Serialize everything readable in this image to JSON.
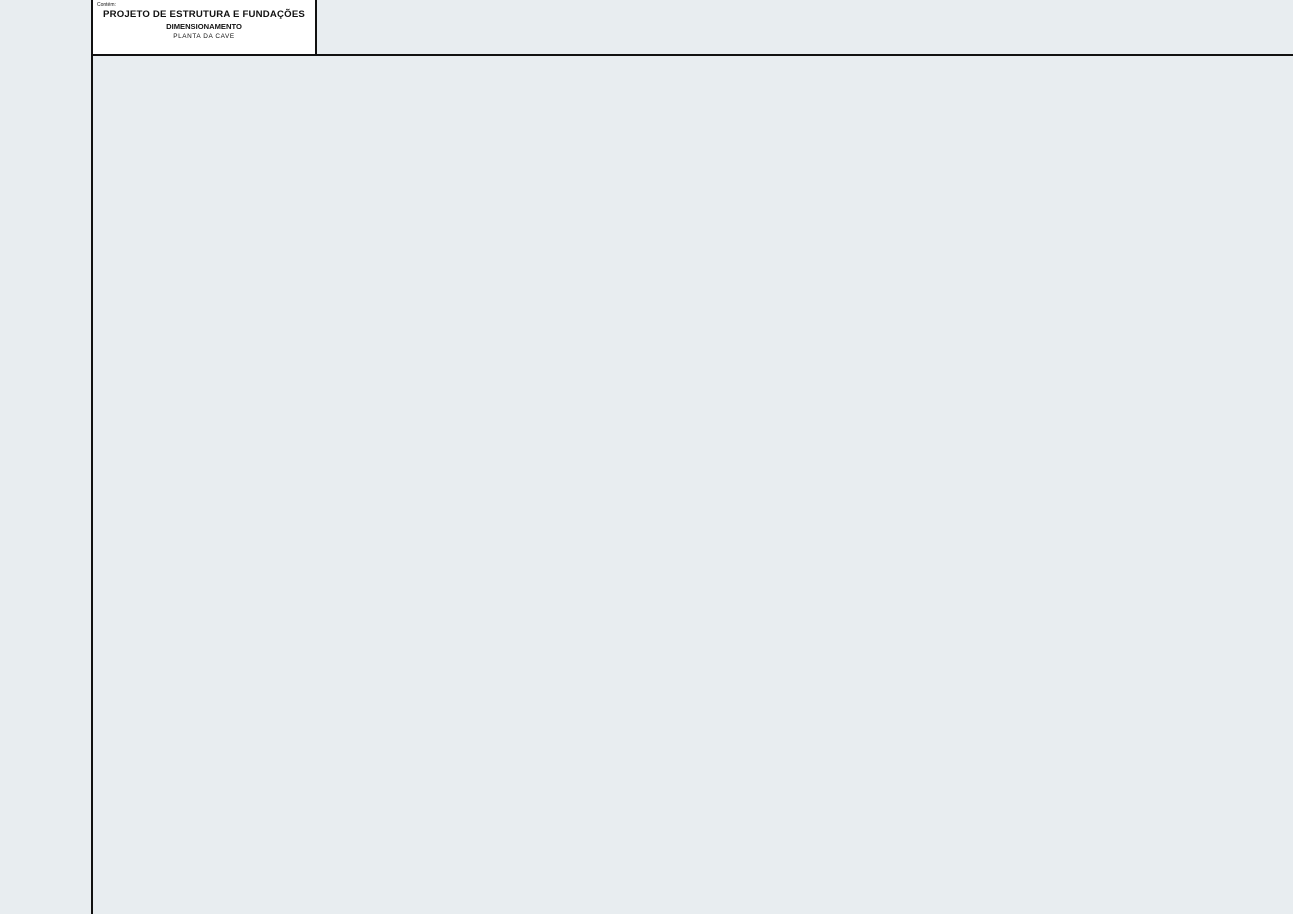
{
  "plan": {
    "annotations": {
      "ramp": "Rampa Incl.15,15%",
      "roller": "Rolo",
      "mlr_upper": "MLR",
      "mlr_lower": "MLR",
      "wall_note_l1": "Contorno",
      "wall_note_l2": "muro sup.",
      "room_p": "P",
      "room_d": "D",
      "level_tags": [
        {
          "l1": "P1.05",
          "l2": "-4.10"
        },
        {
          "l1": "P1.03",
          "l2": "-2.80"
        },
        {
          "l1": "P1.02",
          "l2": "-3.60"
        }
      ]
    }
  },
  "legend": {
    "title": "LEGENDA:",
    "items": [
      {
        "symbol": "pilar",
        "label": "-Pilar"
      },
      {
        "symbol": "pilar-nasce-na-laje",
        "label": "-Pilar nasce na laje"
      },
      {
        "symbol": "abertura-na-laje",
        "label": "-Abertura na Laje"
      }
    ]
  },
  "eurocodes": {
    "title": "EUROCÓDIGOS APLICÁVEIS",
    "items": [
      "NP EN 1990 (2009)",
      "NP EN 1991-1-1 (2009)",
      "NP EN 1991-1-4 (2009)",
      "NP EN 1992-1-1 (2010)",
      "NP EN 1994-1-1 (2011)",
      "NP EN 1997-1-1 (2010)",
      "NP EN 1998-1 (2010)"
    ]
  },
  "concrete": {
    "title": "BETÃO",
    "title_note": "(NP EN 206-1)",
    "rows": [
      {
        "elements": [
          "Fundações",
          "Muros"
        ],
        "spec": "C25/30 XC2 Dmáx. 20 Cl 0.20 S3"
      },
      {
        "elements": [
          "Pilares",
          "Vigas",
          "Lajes"
        ],
        "spec": "C30/37 XC3 Dmáx. 15 Cl 0.20 S3"
      },
      {
        "elements": [
          "Piscina"
        ],
        "spec": "C40/50 XC1 Dmáx. 20 CL 0.20 S3"
      }
    ],
    "steel_title": "AÇO",
    "steel_note": "(NP ENV 13670-1)",
    "steel_row": {
      "element": "Fundações e Estruturas",
      "spec": "A 500 NR SD"
    }
  },
  "covers": {
    "title": "RECOBRIMENTOS",
    "rows": [
      {
        "element": "Fundações",
        "value": "50 mm"
      },
      {
        "element": "Muros",
        "value": "50 mm"
      },
      {
        "element": "Pilares",
        "value": "35 mm"
      },
      {
        "element": "Vigas",
        "value": "35 mm"
      },
      {
        "element": "Lajes",
        "value": "35 mm"
      }
    ]
  },
  "titleblock": {
    "contains_label": "Contém:",
    "line1": "PROJETO DE ESTRUTURA E FUNDAÇÕES",
    "line2": "DIMENSIONAMENTO",
    "line3": "PLANTA DA CAVE"
  },
  "colors": {
    "paper": "#ffffff",
    "ink": "#1a1a1a",
    "cell_fill": "#e8edf0"
  }
}
